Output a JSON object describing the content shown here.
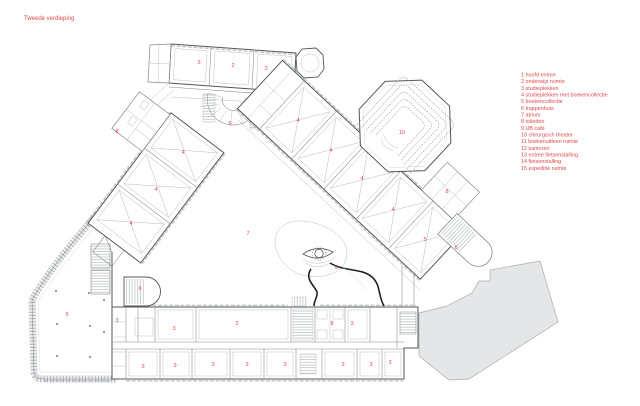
{
  "page": {
    "title": "Tweede verdieping"
  },
  "colors": {
    "label_red": "#df4a4e",
    "wall": "#53575a",
    "line_light": "#b4b8ba",
    "roof_fill": "#e9eaeb",
    "roof_hatch": "#cdd0d1"
  },
  "legend": {
    "items": [
      {
        "n": "1",
        "label": "hoofd entree"
      },
      {
        "n": "2",
        "label": "onderwijs ruimte"
      },
      {
        "n": "3",
        "label": "studieplekken"
      },
      {
        "n": "4",
        "label": "studieplekken met boekencollectie"
      },
      {
        "n": "5",
        "label": "boekencollectie"
      },
      {
        "n": "6",
        "label": "trappenhuis"
      },
      {
        "n": "7",
        "label": "atrium"
      },
      {
        "n": "8",
        "label": "toiletten"
      },
      {
        "n": "9",
        "label": "UB café"
      },
      {
        "n": "10",
        "label": "chirurgisch theater"
      },
      {
        "n": "11",
        "label": "boekenuitleen ruimte"
      },
      {
        "n": "12",
        "label": "kantoren"
      },
      {
        "n": "13",
        "label": "entree fietsenstalling"
      },
      {
        "n": "14",
        "label": "fietsenstalling"
      },
      {
        "n": "15",
        "label": "expeditie ruimte"
      }
    ]
  },
  "plan": {
    "room_labels": [
      {
        "n": "3",
        "x": 199,
        "y": 64
      },
      {
        "n": "2",
        "x": 233,
        "y": 67
      },
      {
        "n": "3",
        "x": 266,
        "y": 70
      },
      {
        "n": "6",
        "x": 230,
        "y": 125
      },
      {
        "n": "8",
        "x": 117,
        "y": 133
      },
      {
        "n": "4",
        "x": 183,
        "y": 154
      },
      {
        "n": "4",
        "x": 156,
        "y": 191
      },
      {
        "n": "4",
        "x": 131,
        "y": 225
      },
      {
        "n": "4",
        "x": 298,
        "y": 122
      },
      {
        "n": "4",
        "x": 331,
        "y": 152
      },
      {
        "n": "4",
        "x": 362,
        "y": 180
      },
      {
        "n": "4",
        "x": 393,
        "y": 211
      },
      {
        "n": "5",
        "x": 425,
        "y": 241
      },
      {
        "n": "8",
        "x": 447,
        "y": 193
      },
      {
        "n": "6",
        "x": 456,
        "y": 249
      },
      {
        "n": "10",
        "x": 402,
        "y": 134
      },
      {
        "n": "7",
        "x": 248,
        "y": 235
      },
      {
        "n": "9",
        "x": 336,
        "y": 269
      },
      {
        "n": "6",
        "x": 140,
        "y": 290
      },
      {
        "n": "5",
        "x": 67,
        "y": 316
      },
      {
        "n": "3",
        "x": 117,
        "y": 322
      },
      {
        "n": "3",
        "x": 174,
        "y": 330
      },
      {
        "n": "2",
        "x": 237,
        "y": 325
      },
      {
        "n": "8",
        "x": 332,
        "y": 325
      },
      {
        "n": "3",
        "x": 352,
        "y": 325
      },
      {
        "n": "3",
        "x": 143,
        "y": 368
      },
      {
        "n": "3",
        "x": 175,
        "y": 367
      },
      {
        "n": "3",
        "x": 213,
        "y": 366
      },
      {
        "n": "3",
        "x": 247,
        "y": 366
      },
      {
        "n": "3",
        "x": 285,
        "y": 366
      },
      {
        "n": "3",
        "x": 343,
        "y": 366
      },
      {
        "n": "3",
        "x": 371,
        "y": 366
      },
      {
        "n": "3",
        "x": 390,
        "y": 364
      }
    ]
  }
}
